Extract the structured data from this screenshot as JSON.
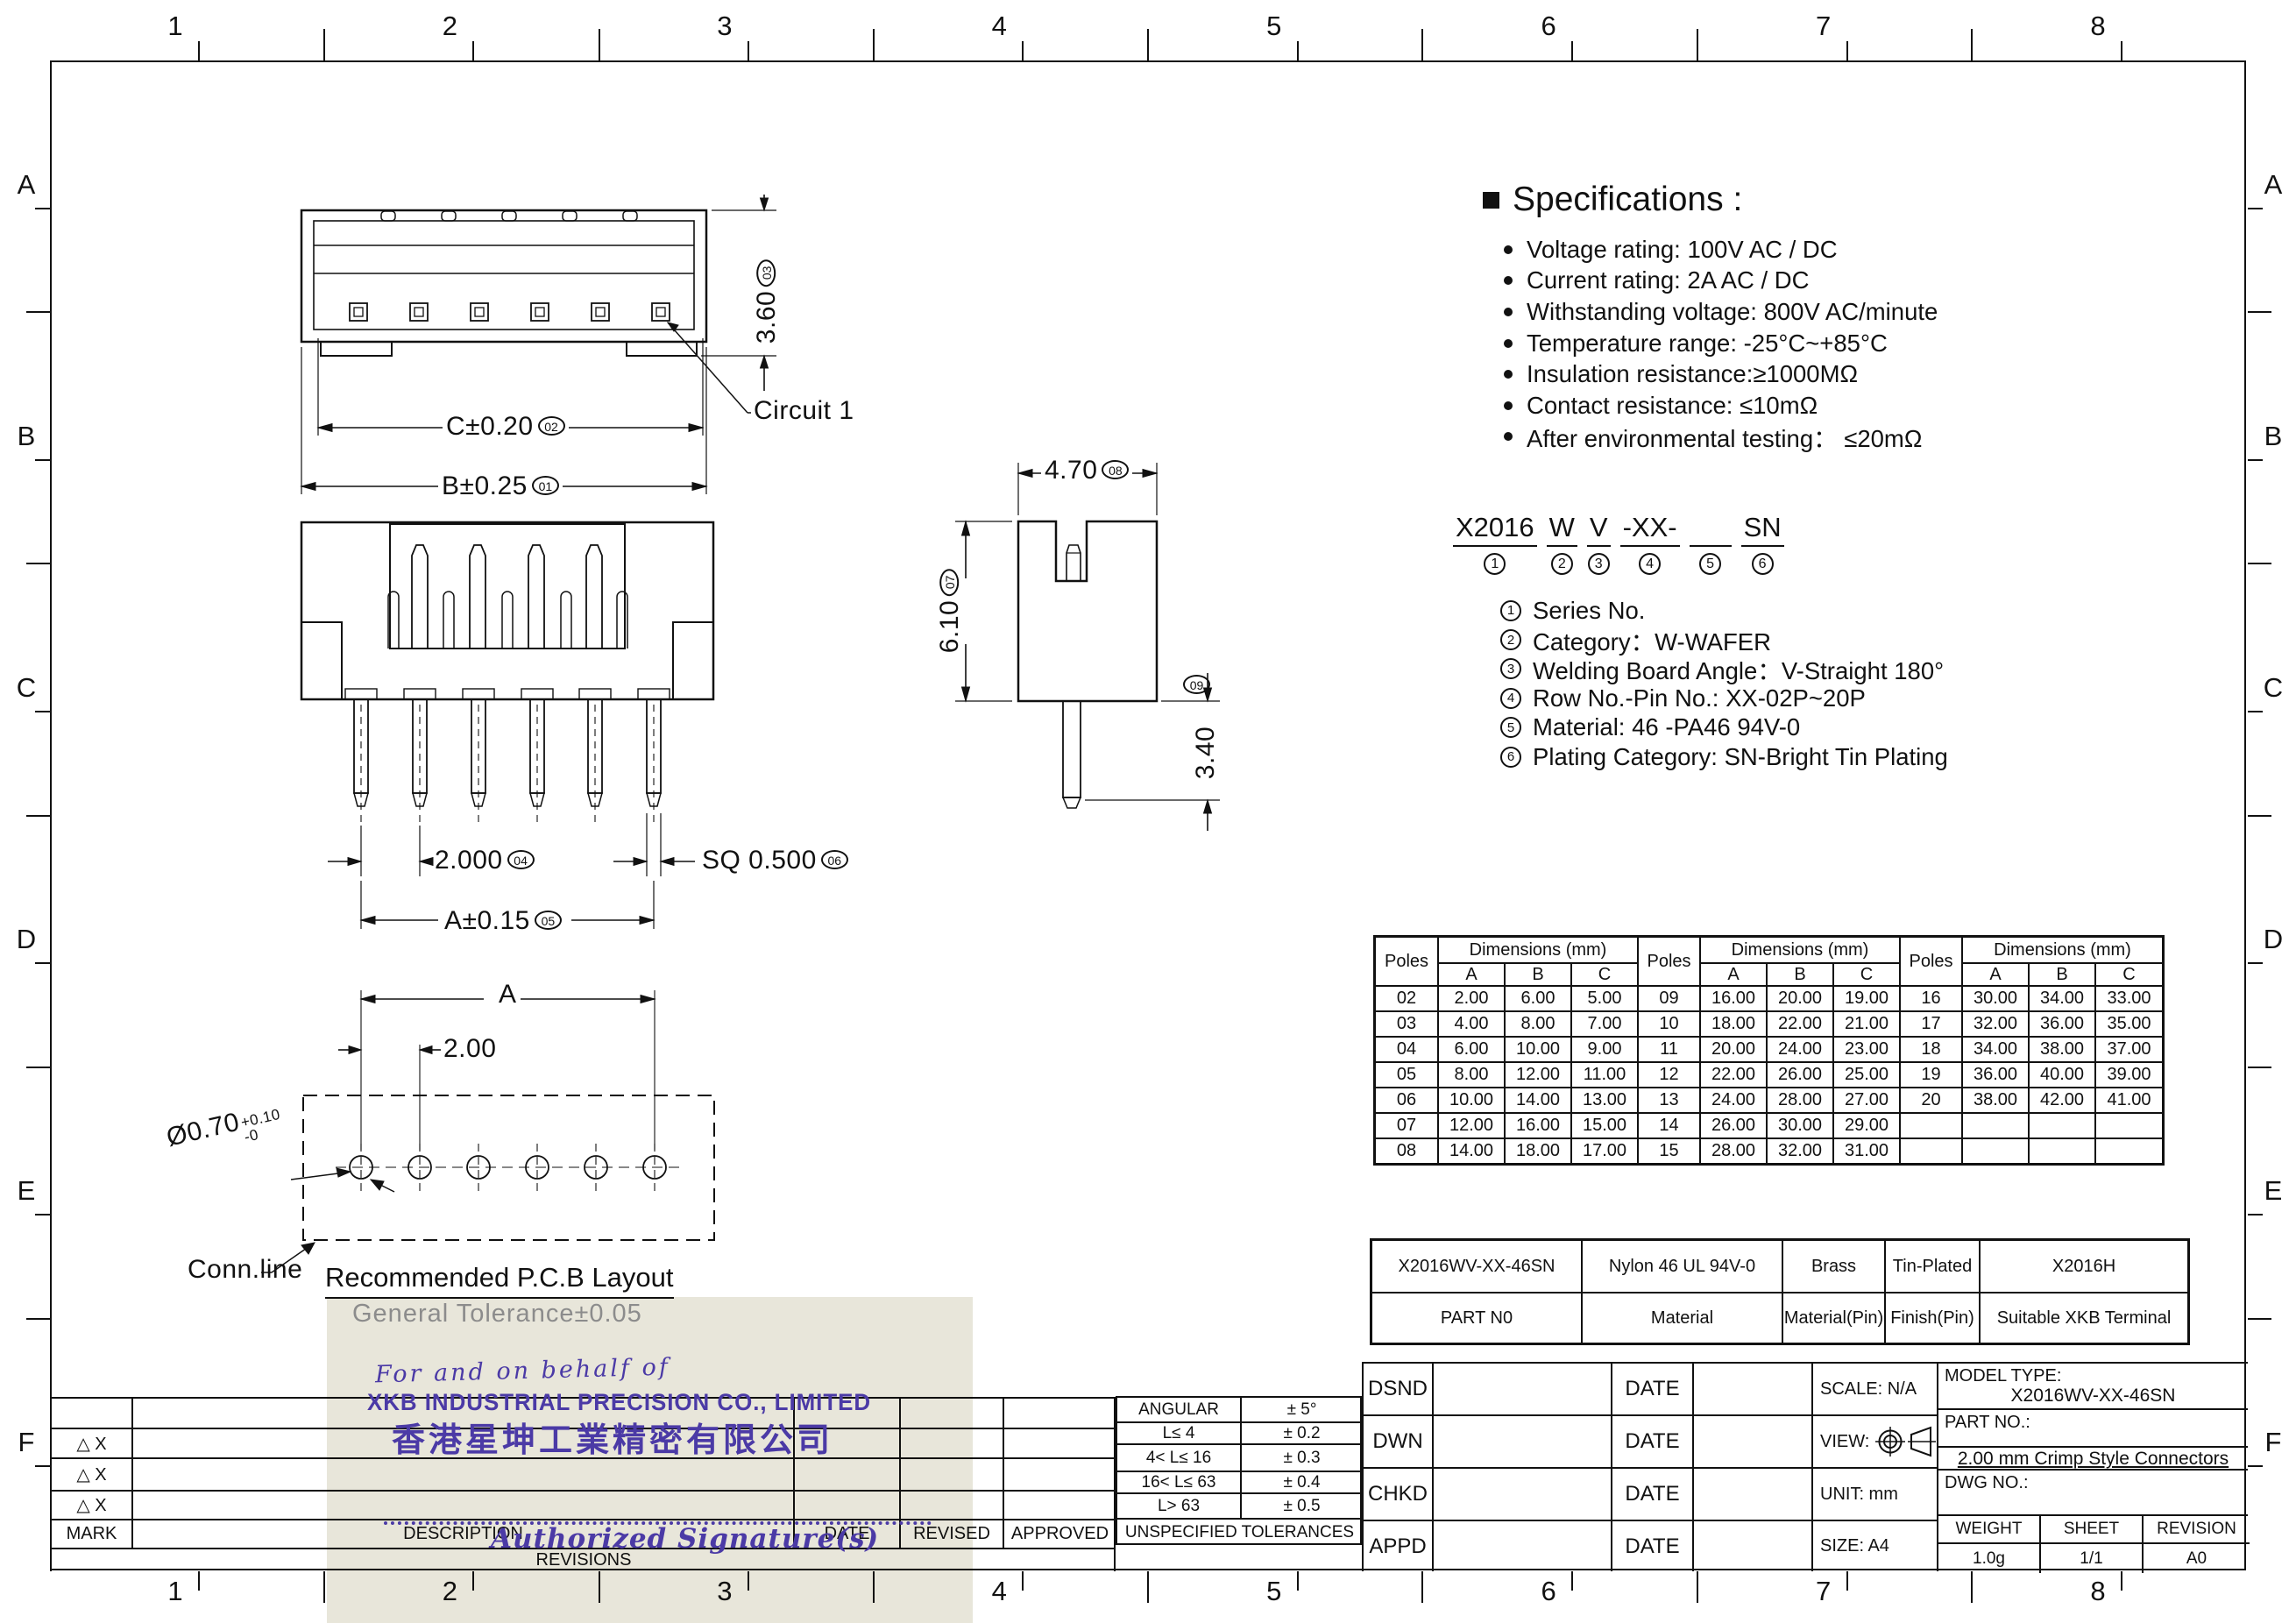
{
  "border": {
    "columns": [
      "1",
      "2",
      "3",
      "4",
      "5",
      "6",
      "7",
      "8"
    ],
    "rows": [
      "A",
      "B",
      "C",
      "D",
      "E",
      "F"
    ]
  },
  "drawing": {
    "top_view": {
      "dim_c": "C±0.20",
      "ref_c": "02",
      "dim_b": "B±0.25",
      "ref_b": "01",
      "dim_h": "3.60",
      "ref_h": "03",
      "circuit_label": "Circuit 1"
    },
    "front_view": {
      "dim_pitch": "2.000",
      "ref_pitch": "04",
      "dim_sq": "SQ 0.500",
      "ref_sq": "06",
      "dim_a": "A±0.15",
      "ref_a": "05"
    },
    "side_view": {
      "dim_w": "4.70",
      "ref_w": "08",
      "dim_h": "6.10",
      "ref_h": "07",
      "dim_pin": "3.40",
      "ref_pin": "09"
    },
    "pcb_layout": {
      "dim_a": "A",
      "dim_pitch": "2.00",
      "hole_dia": "Ø0.70",
      "hole_tol_plus": "+0.10",
      "hole_tol_minus": "-0",
      "conn_label": "Conn.line",
      "title": "Recommended P.C.B Layout",
      "tolerance_note": "General Tolerance±0.05"
    }
  },
  "specifications": {
    "title": "Specifications :",
    "items": [
      "Voltage rating: 100V AC / DC",
      "Current rating: 2A  AC / DC",
      "Withstanding voltage: 800V AC/minute",
      "Temperature range: -25°C~+85°C",
      "Insulation resistance:≥1000MΩ",
      "Contact resistance: ≤10mΩ",
      "After environmental testing：  ≤20mΩ"
    ]
  },
  "part_code": {
    "segments": [
      {
        "text": "X2016",
        "ref": "1"
      },
      {
        "text": "W",
        "ref": "2"
      },
      {
        "text": "V",
        "ref": "3"
      },
      {
        "text": "-XX-",
        "ref": "4"
      },
      {
        "text": " ",
        "ref": "5"
      },
      {
        "text": "SN",
        "ref": "6"
      }
    ],
    "legend": [
      {
        "ref": "1",
        "text": "Series No."
      },
      {
        "ref": "2",
        "text": "Category：W-WAFER"
      },
      {
        "ref": "3",
        "text": "Welding Board Angle：V-Straight 180°"
      },
      {
        "ref": "4",
        "text": "Row No.-Pin No.:  XX-02P~20P"
      },
      {
        "ref": "5",
        "text": "Material:  46 -PA46 94V-0"
      },
      {
        "ref": "6",
        "text": "Plating Category:  SN-Bright Tin Plating"
      }
    ]
  },
  "poles_table": {
    "poles_header": "Poles",
    "dims_header": "Dimensions (mm)",
    "columns": [
      "A",
      "B",
      "C"
    ],
    "groups": [
      [
        {
          "poles": "02",
          "a": "2.00",
          "b": "6.00",
          "c": "5.00"
        },
        {
          "poles": "03",
          "a": "4.00",
          "b": "8.00",
          "c": "7.00"
        },
        {
          "poles": "04",
          "a": "6.00",
          "b": "10.00",
          "c": "9.00"
        },
        {
          "poles": "05",
          "a": "8.00",
          "b": "12.00",
          "c": "11.00"
        },
        {
          "poles": "06",
          "a": "10.00",
          "b": "14.00",
          "c": "13.00"
        },
        {
          "poles": "07",
          "a": "12.00",
          "b": "16.00",
          "c": "15.00"
        },
        {
          "poles": "08",
          "a": "14.00",
          "b": "18.00",
          "c": "17.00"
        }
      ],
      [
        {
          "poles": "09",
          "a": "16.00",
          "b": "20.00",
          "c": "19.00"
        },
        {
          "poles": "10",
          "a": "18.00",
          "b": "22.00",
          "c": "21.00"
        },
        {
          "poles": "11",
          "a": "20.00",
          "b": "24.00",
          "c": "23.00"
        },
        {
          "poles": "12",
          "a": "22.00",
          "b": "26.00",
          "c": "25.00"
        },
        {
          "poles": "13",
          "a": "24.00",
          "b": "28.00",
          "c": "27.00"
        },
        {
          "poles": "14",
          "a": "26.00",
          "b": "30.00",
          "c": "29.00"
        },
        {
          "poles": "15",
          "a": "28.00",
          "b": "32.00",
          "c": "31.00"
        }
      ],
      [
        {
          "poles": "16",
          "a": "30.00",
          "b": "34.00",
          "c": "33.00"
        },
        {
          "poles": "17",
          "a": "32.00",
          "b": "36.00",
          "c": "35.00"
        },
        {
          "poles": "18",
          "a": "34.00",
          "b": "38.00",
          "c": "37.00"
        },
        {
          "poles": "19",
          "a": "36.00",
          "b": "40.00",
          "c": "39.00"
        },
        {
          "poles": "20",
          "a": "38.00",
          "b": "42.00",
          "c": "41.00"
        },
        {
          "poles": "",
          "a": "",
          "b": "",
          "c": ""
        },
        {
          "poles": "",
          "a": "",
          "b": "",
          "c": ""
        }
      ]
    ]
  },
  "material_table": {
    "values": [
      "X2016WV-XX-46SN",
      "Nylon 46  UL 94V-0",
      "Brass",
      "Tin-Plated",
      "X2016H"
    ],
    "labels": [
      "PART N0",
      "Material",
      "Material(Pin)",
      "Finish(Pin)",
      "Suitable XKB Terminal"
    ]
  },
  "revision_table": {
    "mark_rows": [
      "",
      "△ X",
      "△ X",
      "△ X"
    ],
    "mark_label": "MARK",
    "description_label": "DESCRIPTION",
    "date_label": "DATE",
    "revised_label": "REVISED",
    "approved_label": "APPROVED",
    "revisions_label": "REVISIONS"
  },
  "tolerance_table": {
    "rows": [
      {
        "range": "ANGULAR",
        "tol": "± 5°"
      },
      {
        "range": "L≤ 4",
        "tol": "± 0.2"
      },
      {
        "range": "4< L≤ 16",
        "tol": "± 0.3"
      },
      {
        "range": "16< L≤ 63",
        "tol": "± 0.4"
      },
      {
        "range": "L> 63",
        "tol": "± 0.5"
      }
    ],
    "footer": "UNSPECIFIED  TOLERANCES"
  },
  "title_block": {
    "rows": [
      {
        "label": "DSND",
        "date": "DATE"
      },
      {
        "label": "DWN",
        "date": "DATE"
      },
      {
        "label": "CHKD",
        "date": "DATE"
      },
      {
        "label": "APPD",
        "date": "DATE"
      }
    ],
    "info": [
      "SCALE: N/A",
      "VIEW:",
      "UNIT:  mm",
      "SIZE:  A4"
    ],
    "model_type_label": "MODEL TYPE:",
    "model_type": "X2016WV-XX-46SN",
    "part_no_label": "PART NO.:",
    "product_name": "2.00 mm Crimp Style Connectors",
    "dwg_no_label": "DWG NO.:",
    "weight_label": "WEIGHT",
    "weight": "1.0g",
    "sheet_label": "SHEET",
    "sheet": "1/1",
    "revision_label": "REVISION",
    "revision": "A0"
  },
  "stamp": {
    "line1": "For and on behalf of",
    "line2": "XKB INDUSTRIAL PRECISION CO., LIMITED",
    "line3": "香港星坤工業精密有限公司",
    "line4": "Authorized Signature(s)"
  },
  "colors": {
    "line": "#111111",
    "stamp_purple": "#4b3aa6",
    "stamp_paper": "#e8e6da",
    "tolerance_gray": "#8c8c8c"
  }
}
